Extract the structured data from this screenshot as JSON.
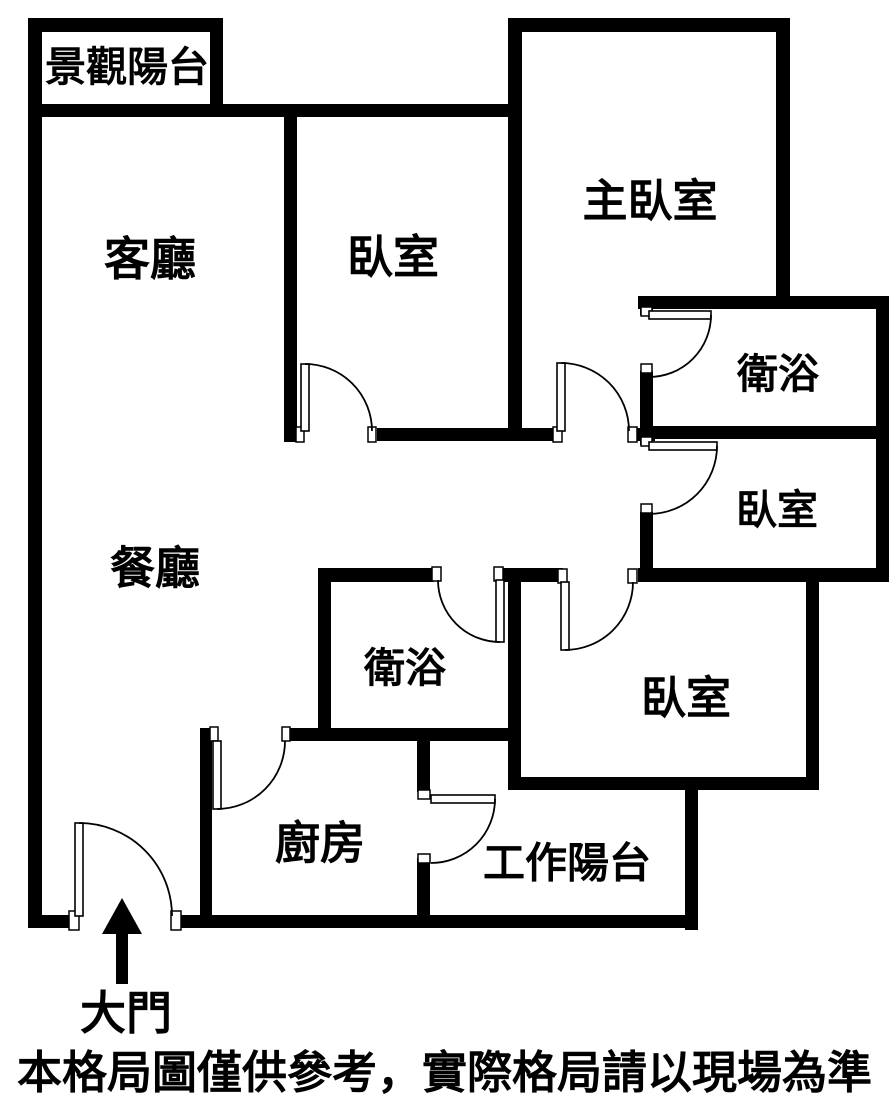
{
  "canvas": {
    "width": 889,
    "height": 1109
  },
  "colors": {
    "wall": "#000000",
    "background": "#ffffff",
    "door_line": "#000000",
    "text": "#000000"
  },
  "disclaimer": "本格局圖僅供參考，實際格局請以現場為準",
  "entrance": {
    "label": "大門",
    "x": 126,
    "y": 1013,
    "font_size": 46,
    "arrow": {
      "shaft": [
        116,
        928,
        12,
        56
      ],
      "head_points": "122,898 102,934 142,934"
    }
  },
  "rooms": [
    {
      "id": "scenic-balcony",
      "label": "景觀陽台",
      "x": 127,
      "y": 67,
      "font_size": 41
    },
    {
      "id": "living-room",
      "label": "客廳",
      "x": 150,
      "y": 259,
      "font_size": 46
    },
    {
      "id": "bedroom-top",
      "label": "臥室",
      "x": 393,
      "y": 257,
      "font_size": 46
    },
    {
      "id": "master-bedroom",
      "label": "主臥室",
      "x": 650,
      "y": 201,
      "font_size": 45
    },
    {
      "id": "bathroom-right",
      "label": "衛浴",
      "x": 778,
      "y": 374,
      "font_size": 41
    },
    {
      "id": "bedroom-right",
      "label": "臥室",
      "x": 777,
      "y": 510,
      "font_size": 41
    },
    {
      "id": "dining-room",
      "label": "餐廳",
      "x": 155,
      "y": 568,
      "font_size": 45
    },
    {
      "id": "bathroom-middle",
      "label": "衛浴",
      "x": 405,
      "y": 668,
      "font_size": 41
    },
    {
      "id": "bedroom-bottom",
      "label": "臥室",
      "x": 686,
      "y": 698,
      "font_size": 45
    },
    {
      "id": "kitchen",
      "label": "廚房",
      "x": 320,
      "y": 843,
      "font_size": 45
    },
    {
      "id": "work-balcony",
      "label": "工作陽台",
      "x": 567,
      "y": 863,
      "font_size": 42
    }
  ],
  "walls": [
    [
      28,
      18,
      14,
      910
    ],
    [
      28,
      18,
      195,
      14
    ],
    [
      210,
      18,
      13,
      99
    ],
    [
      28,
      104,
      494,
      13
    ],
    [
      508,
      18,
      14,
      412
    ],
    [
      508,
      18,
      282,
      14
    ],
    [
      776,
      18,
      14,
      291
    ],
    [
      638,
      296,
      251,
      13
    ],
    [
      876,
      296,
      13,
      284
    ],
    [
      640,
      296,
      13,
      19
    ],
    [
      640,
      371,
      13,
      74
    ],
    [
      640,
      512,
      13,
      58
    ],
    [
      640,
      426,
      249,
      13
    ],
    [
      284,
      104,
      13,
      338
    ],
    [
      377,
      428,
      178,
      13
    ],
    [
      635,
      428,
      20,
      13
    ],
    [
      318,
      568,
      116,
      14
    ],
    [
      503,
      568,
      60,
      14
    ],
    [
      638,
      568,
      251,
      14
    ],
    [
      508,
      568,
      13,
      222
    ],
    [
      806,
      568,
      13,
      222
    ],
    [
      508,
      777,
      311,
      13
    ],
    [
      685,
      783,
      13,
      147
    ],
    [
      318,
      568,
      13,
      172
    ],
    [
      200,
      728,
      16,
      13
    ],
    [
      287,
      728,
      234,
      13
    ],
    [
      200,
      728,
      12,
      188
    ],
    [
      417,
      728,
      13,
      64
    ],
    [
      417,
      858,
      13,
      58
    ],
    [
      28,
      915,
      44,
      13
    ],
    [
      179,
      915,
      519,
      13
    ]
  ],
  "door_posts": [
    [
      296,
      427,
      8,
      15
    ],
    [
      368,
      427,
      8,
      15
    ],
    [
      553,
      427,
      9,
      15
    ],
    [
      628,
      427,
      9,
      15
    ],
    [
      641,
      307,
      11,
      9
    ],
    [
      641,
      364,
      11,
      9
    ],
    [
      641,
      437,
      11,
      9
    ],
    [
      641,
      504,
      11,
      9
    ],
    [
      432,
      567,
      9,
      14
    ],
    [
      494,
      567,
      9,
      14
    ],
    [
      558,
      569,
      9,
      14
    ],
    [
      628,
      569,
      9,
      14
    ],
    [
      210,
      727,
      8,
      14
    ],
    [
      282,
      727,
      8,
      14
    ],
    [
      418,
      790,
      12,
      9
    ],
    [
      418,
      854,
      12,
      9
    ],
    [
      69,
      911,
      10,
      19
    ],
    [
      171,
      911,
      10,
      19
    ]
  ],
  "doors": [
    {
      "id": "bedroom-top-door",
      "hinge": [
        305,
        431
      ],
      "tip": [
        305,
        364
      ],
      "end": [
        372,
        431
      ],
      "sweep": 1
    },
    {
      "id": "master-bedroom-door",
      "hinge": [
        561,
        431
      ],
      "tip": [
        561,
        363
      ],
      "end": [
        629,
        431
      ],
      "sweep": 1
    },
    {
      "id": "bathroom-right-door",
      "hinge": [
        649,
        315
      ],
      "tip": [
        711,
        315
      ],
      "end": [
        649,
        377
      ],
      "sweep": 1
    },
    {
      "id": "bedroom-right-door",
      "hinge": [
        649,
        446
      ],
      "tip": [
        717,
        446
      ],
      "end": [
        649,
        514
      ],
      "sweep": 1
    },
    {
      "id": "bathroom-middle-door",
      "hinge": [
        500,
        580
      ],
      "tip": [
        500,
        642
      ],
      "end": [
        438,
        580
      ],
      "sweep": 1
    },
    {
      "id": "bedroom-bottom-door",
      "hinge": [
        565,
        582
      ],
      "tip": [
        565,
        650
      ],
      "end": [
        633,
        582
      ],
      "sweep": 0
    },
    {
      "id": "kitchen-door",
      "hinge": [
        217,
        741
      ],
      "tip": [
        217,
        809
      ],
      "end": [
        285,
        741
      ],
      "sweep": 0
    },
    {
      "id": "work-balcony-door",
      "hinge": [
        431,
        799
      ],
      "tip": [
        495,
        799
      ],
      "end": [
        431,
        863
      ],
      "sweep": 1
    },
    {
      "id": "main-entrance-door",
      "hinge": [
        79,
        916
      ],
      "tip": [
        79,
        823
      ],
      "end": [
        172,
        916
      ],
      "sweep": 1
    }
  ]
}
